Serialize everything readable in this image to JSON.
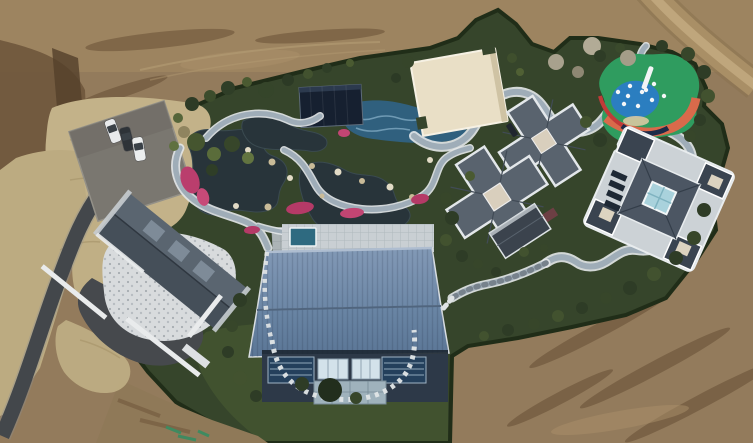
{
  "scene": {
    "colors": {
      "dirt": "#937b5c",
      "dirtLight": "#a68c64",
      "dirtDark": "#6f573c",
      "dryGrass": "#c3b289",
      "garden": "#36452b",
      "lawn": "#41522f",
      "pond": "#28343a",
      "poolBlue": "#30607e",
      "stonePath": "#9fadb8",
      "asphalt": "#43474b",
      "creamRoof": "#e9dfc6",
      "playGreen": "#2f9c5f",
      "playBlue": "#2b7ec0",
      "playCoral": "#d96a4b",
      "playRed": "#c13a38",
      "grayRoof": "#59636e",
      "blueRoofTop": "#7e95b2",
      "blueRoofBottom": "#64809f",
      "facade": "#2d3948",
      "patio": "#d8dbdd",
      "navyPavilion": "#162030",
      "pinkFlowers": "#ba3e6d",
      "rockLight": "#e2dbc6",
      "rockTan": "#c9bb98",
      "paintMark": "#3f8a60"
    },
    "trees": [
      [
        192,
        104,
        7,
        "#2e3b26"
      ],
      [
        210,
        96,
        6,
        "#3c4c2c"
      ],
      [
        228,
        88,
        7,
        "#2f3e27"
      ],
      [
        247,
        82,
        5,
        "#4a5a31"
      ],
      [
        266,
        90,
        8,
        "#35452a"
      ],
      [
        288,
        80,
        6,
        "#2c3a25"
      ],
      [
        308,
        74,
        5,
        "#42522f"
      ],
      [
        327,
        68,
        5,
        "#2f3e27"
      ],
      [
        350,
        63,
        4,
        "#4a5a31"
      ],
      [
        196,
        142,
        9,
        "#45552f"
      ],
      [
        214,
        154,
        7,
        "#5a6c3a"
      ],
      [
        232,
        144,
        8,
        "#37462a"
      ],
      [
        248,
        158,
        6,
        "#627440"
      ],
      [
        212,
        170,
        6,
        "#2f3e27"
      ],
      [
        184,
        132,
        6,
        "#8f845f"
      ],
      [
        178,
        118,
        5,
        "#55653a"
      ],
      [
        408,
        62,
        6,
        "#36452a"
      ],
      [
        396,
        78,
        5,
        "#2c3a25"
      ],
      [
        512,
        58,
        5,
        "#3f4f2d"
      ],
      [
        520,
        72,
        4,
        "#506034"
      ],
      [
        556,
        62,
        8,
        "#a8a18d"
      ],
      [
        592,
        46,
        9,
        "#b2ab96"
      ],
      [
        628,
        58,
        8,
        "#a49d88"
      ],
      [
        578,
        72,
        6,
        "#8e8773"
      ],
      [
        600,
        56,
        6,
        "#2e3c26"
      ],
      [
        620,
        48,
        5,
        "#3a4a2c"
      ],
      [
        662,
        46,
        6,
        "#2e3c26"
      ],
      [
        688,
        54,
        7,
        "#37462a"
      ],
      [
        704,
        72,
        7,
        "#2e3c26"
      ],
      [
        708,
        96,
        7,
        "#42522f"
      ],
      [
        700,
        120,
        6,
        "#2e3c26"
      ],
      [
        690,
        136,
        6,
        "#37462a"
      ],
      [
        600,
        140,
        7,
        "#2e3c26"
      ],
      [
        586,
        122,
        6,
        "#42522f"
      ],
      [
        612,
        146,
        5,
        "#37462a"
      ],
      [
        704,
        210,
        7,
        "#2e3c26"
      ],
      [
        694,
        238,
        7,
        "#37462a"
      ],
      [
        676,
        258,
        7,
        "#2e3c26"
      ],
      [
        654,
        274,
        7,
        "#42522f"
      ],
      [
        630,
        288,
        7,
        "#2e3c26"
      ],
      [
        606,
        298,
        6,
        "#37462a"
      ],
      [
        582,
        308,
        6,
        "#2e3c26"
      ],
      [
        558,
        316,
        6,
        "#42522f"
      ],
      [
        534,
        324,
        6,
        "#37462a"
      ],
      [
        508,
        330,
        6,
        "#2e3c26"
      ],
      [
        484,
        336,
        5,
        "#42522f"
      ],
      [
        446,
        198,
        6,
        "#37462a"
      ],
      [
        452,
        218,
        7,
        "#2e3c26"
      ],
      [
        446,
        240,
        6,
        "#42522f"
      ],
      [
        462,
        256,
        6,
        "#2e3c26"
      ],
      [
        478,
        264,
        5,
        "#37462a"
      ],
      [
        470,
        176,
        5,
        "#4a5a31"
      ],
      [
        524,
        252,
        5,
        "#42522f"
      ],
      [
        544,
        248,
        4,
        "#37462a"
      ],
      [
        496,
        272,
        5,
        "#2e3c26"
      ],
      [
        240,
        300,
        7,
        "#2e3c26"
      ],
      [
        232,
        326,
        6,
        "#37462a"
      ],
      [
        228,
        352,
        6,
        "#2e3c26"
      ],
      [
        240,
        378,
        7,
        "#42522f"
      ],
      [
        256,
        396,
        6,
        "#2e3c26"
      ],
      [
        330,
        390,
        12,
        "#222e1d"
      ],
      [
        302,
        384,
        7,
        "#2e3c26"
      ],
      [
        356,
        398,
        6,
        "#37462a"
      ],
      [
        174,
        146,
        5,
        "#5f7140"
      ]
    ],
    "rocks": [
      [
        215,
        155,
        4
      ],
      [
        248,
        150,
        3
      ],
      [
        272,
        162,
        3.5
      ],
      [
        290,
        178,
        3
      ],
      [
        312,
        166,
        3
      ],
      [
        338,
        172,
        3.5
      ],
      [
        362,
        181,
        3
      ],
      [
        390,
        187,
        3.5
      ],
      [
        412,
        197,
        3
      ],
      [
        300,
        211,
        3
      ],
      [
        268,
        207,
        3.5
      ],
      [
        236,
        206,
        3
      ],
      [
        322,
        196,
        2.5
      ],
      [
        430,
        160,
        3
      ]
    ],
    "flowers": [
      [
        190,
        180,
        9,
        14,
        -20,
        "#ba3e6d"
      ],
      [
        203,
        197,
        6,
        9,
        -15,
        "#c64a78"
      ],
      [
        300,
        208,
        14,
        6,
        -8,
        "#b53a67"
      ],
      [
        352,
        213,
        12,
        5,
        -5,
        "#c24573"
      ],
      [
        420,
        199,
        9,
        5,
        -10,
        "#b53a67"
      ],
      [
        344,
        133,
        6,
        4,
        0,
        "#c24573"
      ],
      [
        252,
        230,
        8,
        4,
        -5,
        "#b53a67"
      ]
    ],
    "playground_dots": [
      [
        618,
        92
      ],
      [
        630,
        86
      ],
      [
        642,
        92
      ],
      [
        652,
        100
      ],
      [
        638,
        106
      ],
      [
        624,
        104
      ],
      [
        654,
        84
      ],
      [
        664,
        96
      ],
      [
        628,
        96
      ],
      [
        646,
        90
      ]
    ],
    "cars": [
      [
        113,
        131,
        -20,
        "#e8eaec"
      ],
      [
        127,
        139,
        -14,
        "#2e3338"
      ],
      [
        139,
        149,
        -10,
        "#eceeee"
      ]
    ]
  }
}
